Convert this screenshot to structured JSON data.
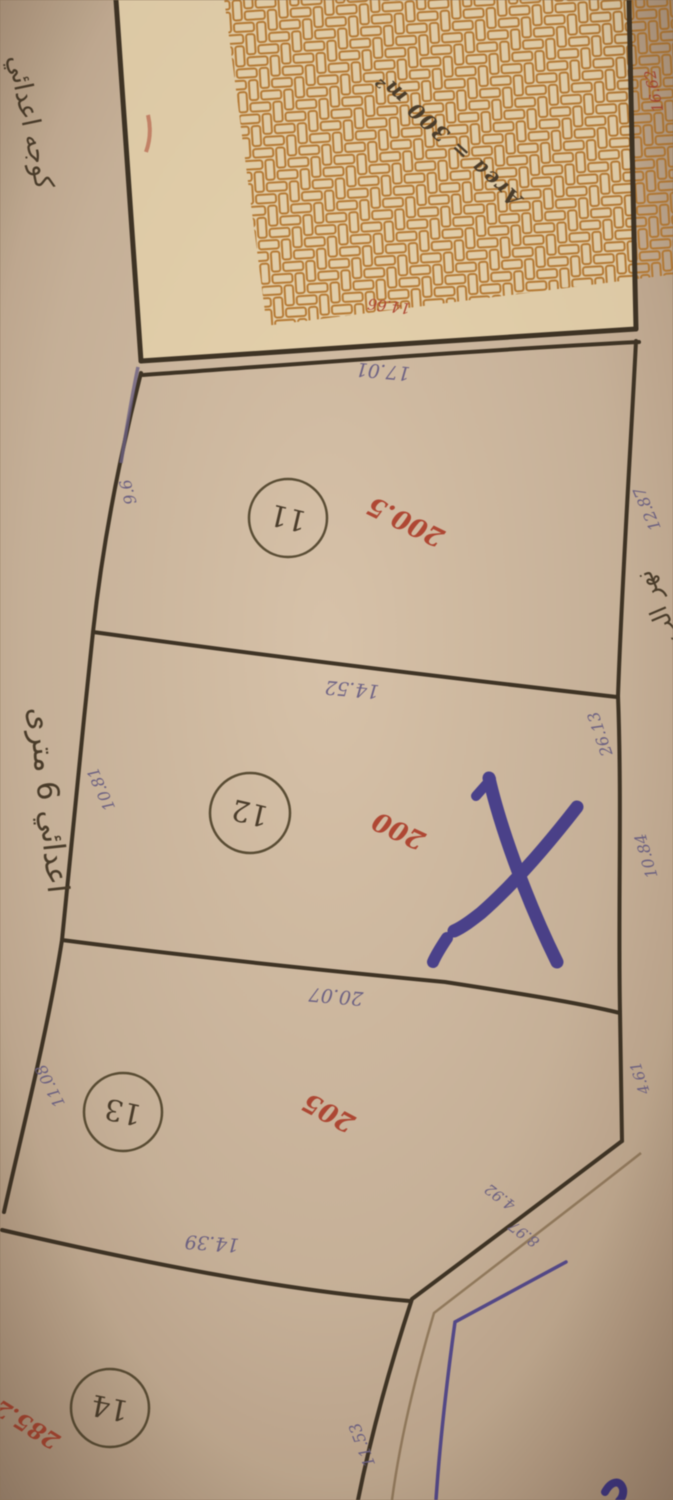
{
  "document_type": "hand-drawn land subdivision survey map (photo, rotated upside-down)",
  "colors": {
    "paper": "#d3bc9f",
    "paper_edge": "#b1967a",
    "hatch_fill": "#e9d3ab",
    "hatch_line": "#bf7d2f",
    "boundary": "#3e3222",
    "ink_dim": "#6e6288",
    "ink_red": "#b8452f",
    "ink_blue": "#3f3691",
    "ink_text": "#4b3c28"
  },
  "hatch_block": {
    "area_label": "Area = 300 m²",
    "bottom_edge_dim": "14.66",
    "right_edge_dim": "16.62"
  },
  "streets": {
    "top_left": "كوجه اعدائي",
    "left": "اعدائي 6 مترى",
    "right": "نهر الب"
  },
  "plots": [
    {
      "number": "11",
      "area": "200.5",
      "top_dim": "17.01",
      "left_dim": "9.6",
      "right_dim": "12.87",
      "bottom_dim": "14.52"
    },
    {
      "number": "12",
      "area": "200",
      "left_dim": "10.81",
      "right_upper_dim": "26.13",
      "right_lower_dim": "10.84",
      "bottom_dim": "20.07",
      "marked_x": true
    },
    {
      "number": "13",
      "area": "205",
      "left_dim": "11.08",
      "right_dim": "4.61",
      "corner_dim": "4.92",
      "edge_dim": "8.97",
      "bottom_dim": "14.39"
    },
    {
      "number": "14",
      "area": "285.2",
      "edge_dim": "11.53"
    }
  ]
}
